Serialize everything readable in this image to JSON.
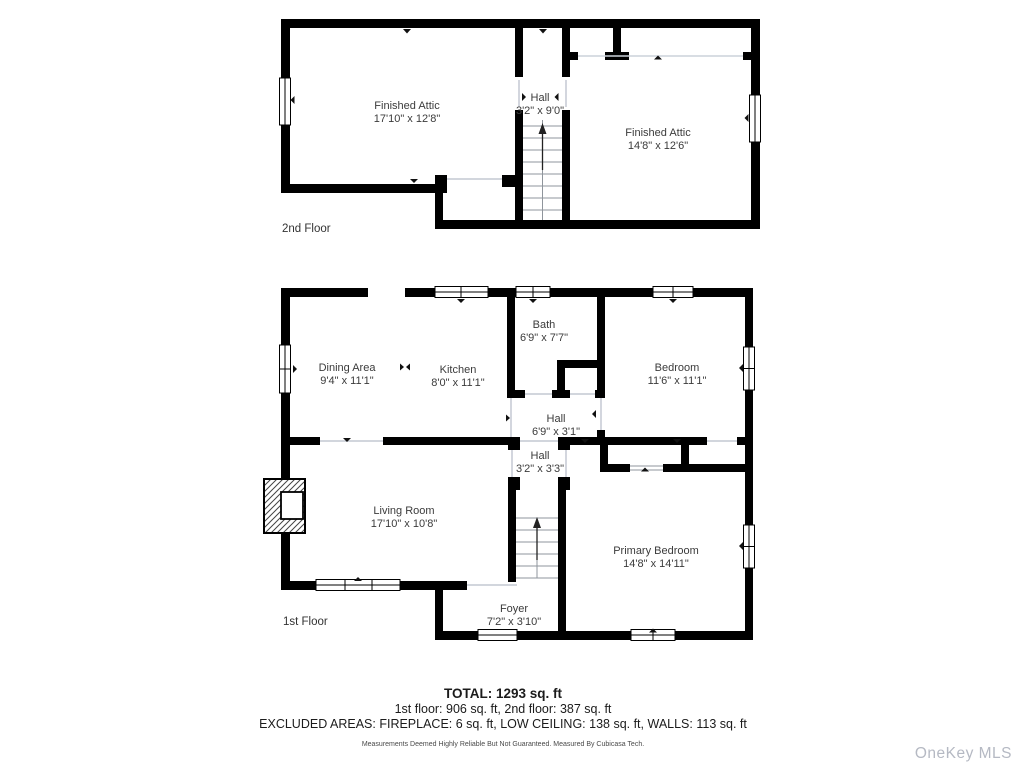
{
  "floors": [
    {
      "label": "2nd Floor",
      "rooms": [
        {
          "name": "Finished Attic",
          "dims": "17'10\" x 12'8\""
        },
        {
          "name": "Hall",
          "dims": "3'2\" x 9'0\""
        },
        {
          "name": "Finished Attic",
          "dims": "14'8\" x 12'6\""
        }
      ]
    },
    {
      "label": "1st Floor",
      "rooms": [
        {
          "name": "Dining Area",
          "dims": "9'4\" x 11'1\""
        },
        {
          "name": "Kitchen",
          "dims": "8'0\" x 11'1\""
        },
        {
          "name": "Bath",
          "dims": "6'9\" x 7'7\""
        },
        {
          "name": "Bedroom",
          "dims": "11'6\" x 11'1\""
        },
        {
          "name": "Hall",
          "dims": "6'9\" x 3'1\""
        },
        {
          "name": "Hall",
          "dims": "3'2\" x 3'3\""
        },
        {
          "name": "Living Room",
          "dims": "17'10\" x 10'8\""
        },
        {
          "name": "Primary Bedroom",
          "dims": "14'8\" x 14'11\""
        },
        {
          "name": "Foyer",
          "dims": "7'2\" x 3'10\""
        }
      ]
    }
  ],
  "summary": {
    "total": "TOTAL: 1293 sq. ft",
    "floors_line": "1st floor: 906 sq. ft, 2nd floor: 387 sq. ft",
    "excluded_line": "EXCLUDED AREAS: FIREPLACE: 6 sq. ft, LOW CEILING: 138 sq. ft, WALLS: 113 sq. ft",
    "disclaimer": "Measurements Deemed Highly Reliable But Not Guaranteed. Measured By Cubicasa Tech."
  },
  "watermark": "OneKey MLS",
  "colors": {
    "walls": "#000000",
    "label_text": "#3b3b3b",
    "opening_line": "#c4c9d2",
    "stair_line": "#8f959c",
    "watermark": "#b5b9c3"
  }
}
